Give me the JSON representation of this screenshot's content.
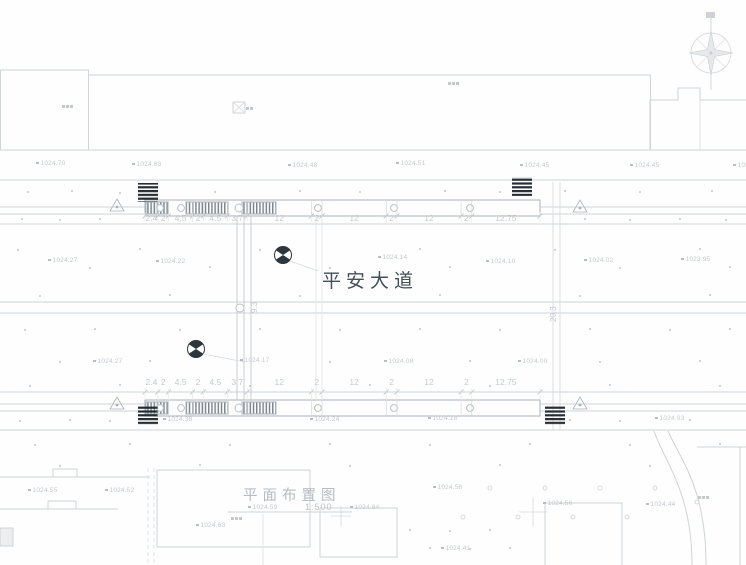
{
  "drawing": {
    "road_name": "平安大道",
    "title": "平面布置图",
    "scale": "1:500"
  },
  "colors": {
    "line": "#cfd4d8",
    "line_faint": "#e1e5e8",
    "text": "#c4cbd1",
    "tick": "#b6bec4",
    "dark": "#2c363c",
    "road_name": "#43505a"
  },
  "dimensions": {
    "chain": [
      "2.4",
      "2",
      "4.5",
      "2",
      "4.5",
      "3.7",
      "12",
      "2",
      "12",
      "2",
      "12",
      "2",
      "12.75"
    ],
    "chain_start_x": 145,
    "chain_end_x": 540,
    "vertical": [
      {
        "label": "9.3",
        "x": 250,
        "y": 313
      },
      {
        "label": "20.3",
        "x": 549,
        "y": 322
      }
    ]
  },
  "elevations": [
    {
      "x": 36,
      "y": 164,
      "label": "1024.70"
    },
    {
      "x": 132,
      "y": 165,
      "label": "1024.63"
    },
    {
      "x": 288,
      "y": 166,
      "label": "1024.48"
    },
    {
      "x": 396,
      "y": 164,
      "label": "1024.51"
    },
    {
      "x": 520,
      "y": 166,
      "label": "1024.45"
    },
    {
      "x": 630,
      "y": 166,
      "label": "1024.45"
    },
    {
      "x": 733,
      "y": 166,
      "label": "1024.46"
    },
    {
      "x": 48,
      "y": 261,
      "label": "1024.27"
    },
    {
      "x": 156,
      "y": 262,
      "label": "1024.22"
    },
    {
      "x": 378,
      "y": 258,
      "label": "1024.14"
    },
    {
      "x": 486,
      "y": 262,
      "label": "1024.10"
    },
    {
      "x": 584,
      "y": 261,
      "label": "1024.02"
    },
    {
      "x": 681,
      "y": 260,
      "label": "1023.95"
    },
    {
      "x": 93,
      "y": 362,
      "label": "1024.27"
    },
    {
      "x": 240,
      "y": 361,
      "label": "1024.17"
    },
    {
      "x": 384,
      "y": 362,
      "label": "1024.08"
    },
    {
      "x": 518,
      "y": 362,
      "label": "1024.00"
    },
    {
      "x": 163,
      "y": 420,
      "label": "1024.38"
    },
    {
      "x": 310,
      "y": 420,
      "label": "1024.24"
    },
    {
      "x": 428,
      "y": 419,
      "label": "1024.18"
    },
    {
      "x": 655,
      "y": 419,
      "label": "1024.03"
    },
    {
      "x": 28,
      "y": 491,
      "label": "1024.55"
    },
    {
      "x": 105,
      "y": 491,
      "label": "1024.52"
    },
    {
      "x": 433,
      "y": 488,
      "label": "1024.58"
    },
    {
      "x": 543,
      "y": 504,
      "label": "1024.56"
    },
    {
      "x": 646,
      "y": 505,
      "label": "1024.44"
    },
    {
      "x": 248,
      "y": 508,
      "label": "1024.59"
    },
    {
      "x": 196,
      "y": 526,
      "label": "1024.63"
    },
    {
      "x": 350,
      "y": 508,
      "label": "1024.84"
    },
    {
      "x": 441,
      "y": 549,
      "label": "1024.41"
    }
  ]
}
